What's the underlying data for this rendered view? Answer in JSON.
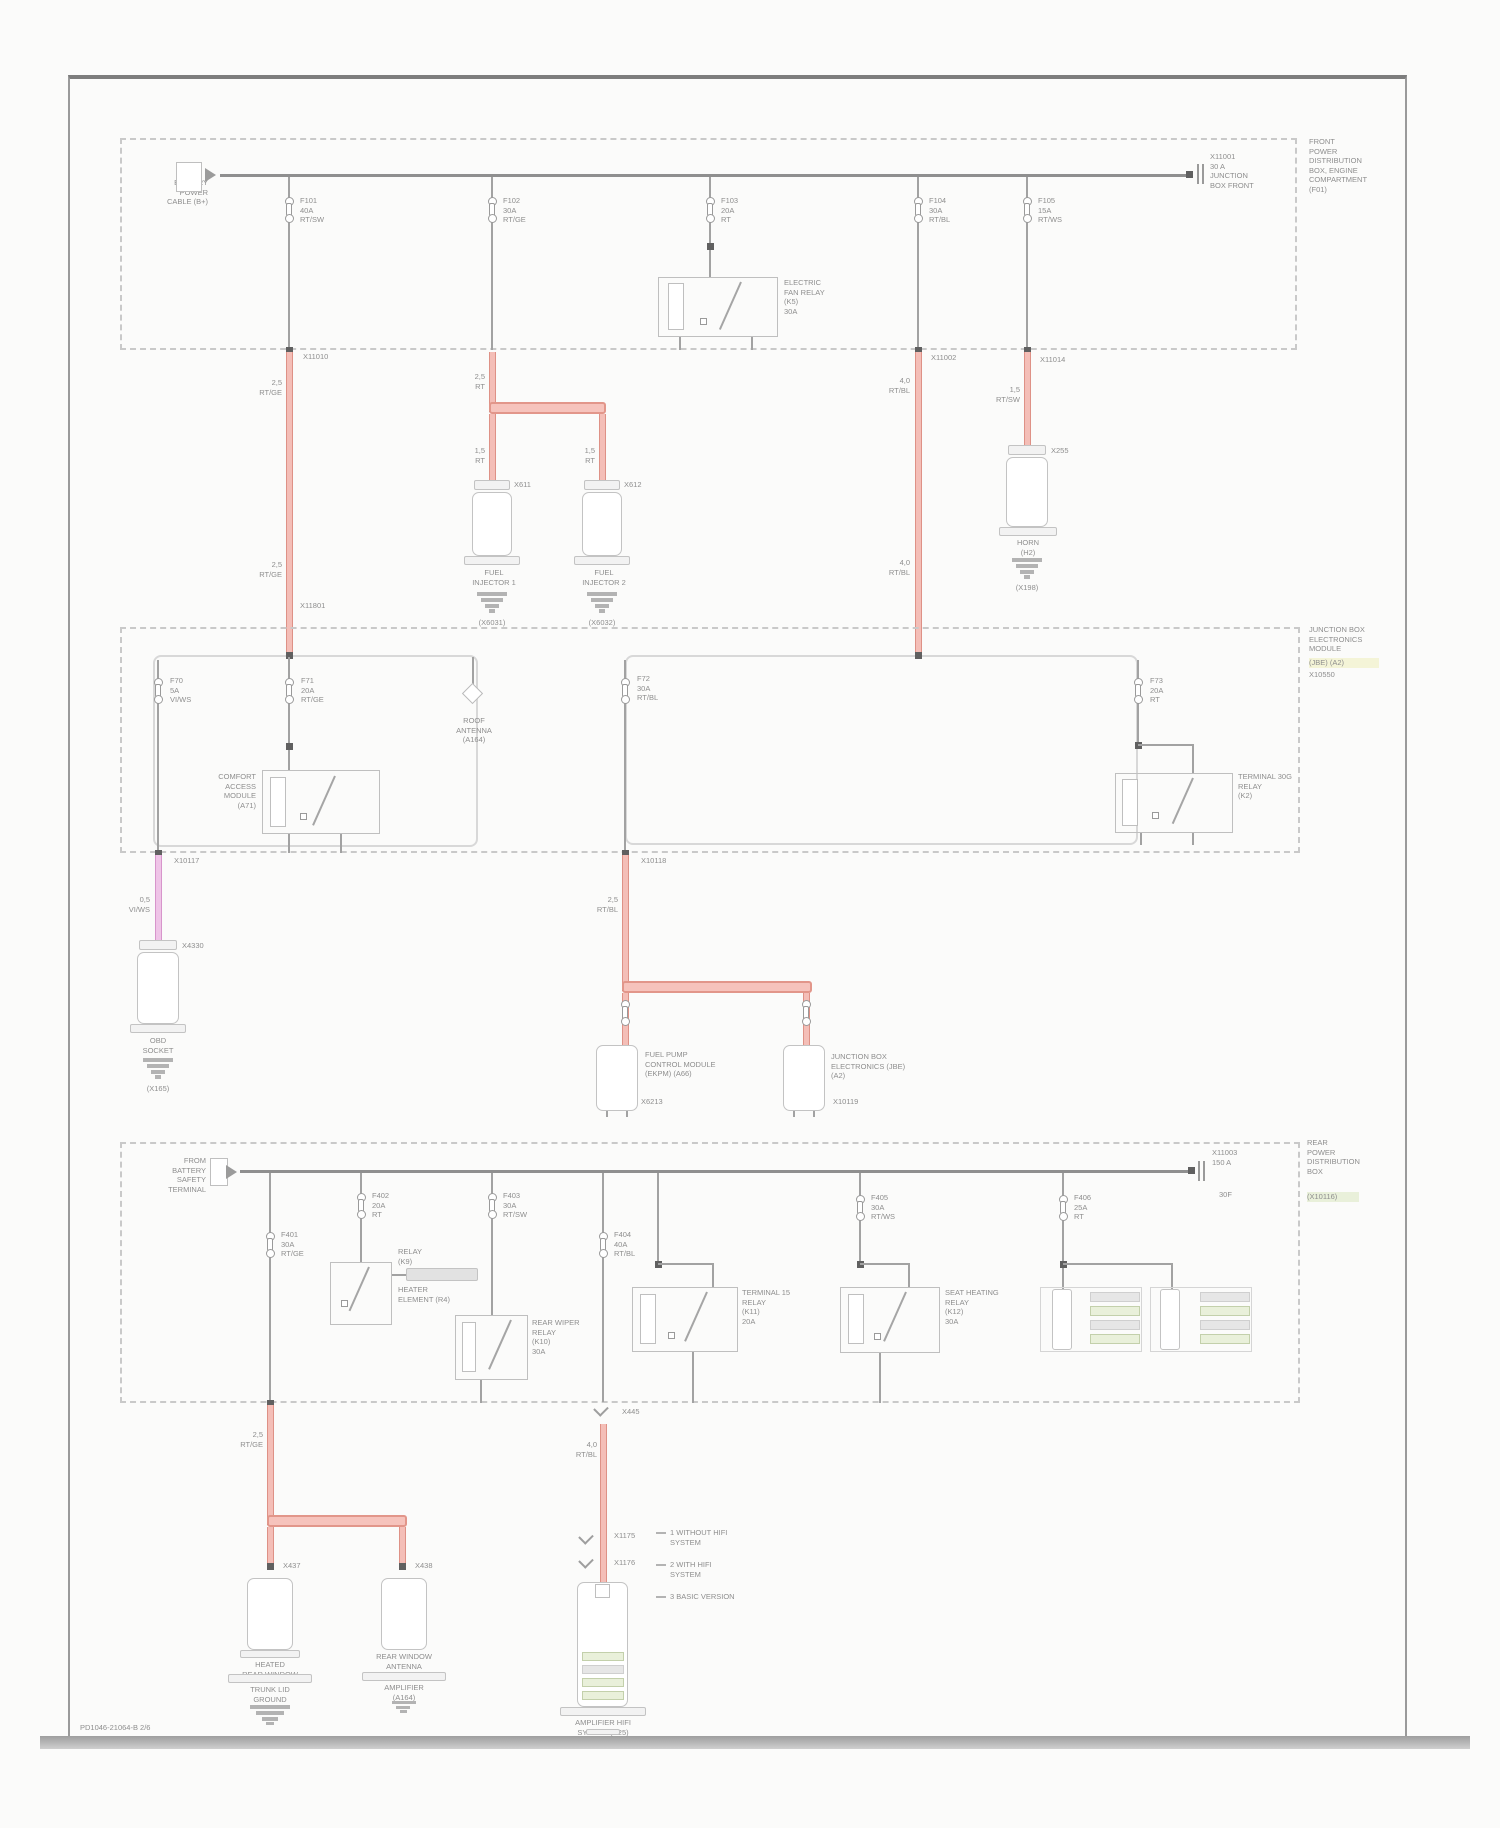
{
  "page": {
    "footer": "PD1046-21064-B  2/6"
  },
  "colors": {
    "wire_red": "#f4beb7",
    "wire_pink": "#efc4e7",
    "wire_gray": "#a2a2a2",
    "highlight_yellow": "#f4f4d7",
    "highlight_green": "#e9f0da"
  },
  "box1": {
    "title": "FRONT\nPOWER\nDISTRIBUTION\nBOX, ENGINE\nCOMPARTMENT\n(F01)",
    "entry": "BATTERY\nPOWER\nCABLE (B+)",
    "term": "X11001\n30 A\nJUNCTION\nBOX FRONT",
    "f1": "F101\n40A\nRT/SW",
    "f2": "F102\n30A\nRT/GE",
    "f3": "F103\n20A\nRT",
    "f4": "F104\n30A\nRT/BL",
    "f5": "F105\n15A\nRT/WS",
    "relay": "ELECTRIC\nFAN RELAY\n(K5)\n30A",
    "x1": "X11010",
    "x1b": "X11801",
    "w1a": "2,5\nRT/GE",
    "w1b": "2,5\nRT/GE",
    "w2": "2,5\nRT",
    "w2l": "1,5\nRT",
    "w2r": "1,5\nRT",
    "x4": "X11002",
    "w4a": "4,0\nRT/BL",
    "w4b": "4,0\nRT/BL",
    "x5": "X11014",
    "w5": "1,5\nRT/SW",
    "c1x": "X611",
    "c1l": "FUEL\nINJECTOR 1",
    "c1g": "(X6031)",
    "c2x": "X612",
    "c2l": "FUEL\nINJECTOR 2",
    "c2g": "(X6032)",
    "c3x": "X255",
    "c3l": "HORN\n(H2)",
    "c3g": "(X198)"
  },
  "box2": {
    "title": "JUNCTION BOX\nELECTRONICS\nMODULE",
    "title_hl": "(JBE) (A2)",
    "title_sub": "X10550",
    "f1": "F70\n5A\nVI/WS",
    "x1": "X10117",
    "w1": "0,5\nVI/WS",
    "c1x": "X4330",
    "c1l": "OBD\nSOCKET",
    "c1g": "(X165)",
    "f2": "F71\n20A\nRT/GE",
    "relay": "COMFORT\nACCESS\nMODULE\n(A71)",
    "ant": "ROOF\nANTENNA\n(A164)",
    "f3": "F72\n30A\nRT/BL",
    "x3": "X10118",
    "w3": "2,5\nRT/BL",
    "p1": "FUEL PUMP\nCONTROL MODULE\n(EKPM) (A66)",
    "p1x": "X6213",
    "p2": "JUNCTION BOX\nELECTRONICS (JBE)\n(A2)",
    "p2x": "X10119",
    "f4": "F73\n20A\nRT",
    "relay2": "TERMINAL 30G\nRELAY\n(K2)"
  },
  "box3": {
    "title": "REAR\nPOWER\nDISTRIBUTION\nBOX",
    "title_hl": "(X10116)",
    "entry": "FROM\nBATTERY\nSAFETY\nTERMINAL",
    "term": "X11003\n150 A",
    "term2": "30F",
    "f1": "F401\n30A\nRT/GE",
    "w1": "2,5\nRT/GE",
    "b1x": "X437",
    "b1l": "HEATED\nREAR WINDOW",
    "b1l2": "TRUNK LID\nGROUND",
    "b1g": "(X979)",
    "b2x": "X438",
    "b2l": "REAR WINDOW\nANTENNA",
    "b2l2": "AMPLIFIER\n(A164)",
    "f2": "F402\n20A\nRT",
    "relayA": "RELAY\n(K9)",
    "elem": "HEATER\nELEMENT (R4)",
    "f3": "F403\n30A\nRT/SW",
    "relayB": "REAR WIPER\nRELAY\n(K10)\n30A",
    "f4": "F404\n40A\nRT/BL",
    "b4x": "X445",
    "w4": "4,0\nRT/BL",
    "b4x1": "X1175",
    "b4x2": "X1176",
    "b4l": "AMPLIFIER HIFI\nSYSTEM (A25)",
    "b4tail": "(X940)",
    "relayC": "TERMINAL 15\nRELAY\n(K11)\n20A",
    "f5": "F405\n30A\nRT/WS",
    "relayD": "SEAT HEATING\nRELAY\n(K12)\n30A",
    "f6": "F406\n25A\nRT",
    "legend1": "1   WITHOUT HIFI\n     SYSTEM",
    "legend2": "2   WITH HIFI\n     SYSTEM",
    "legend3": "3   BASIC VERSION"
  }
}
